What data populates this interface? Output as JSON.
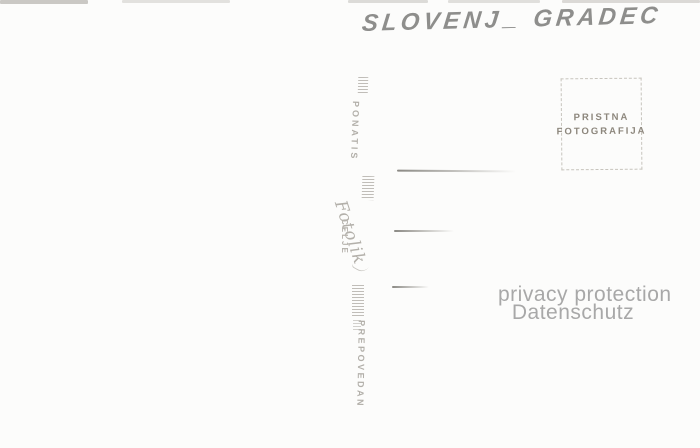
{
  "handwriting": {
    "part1": "SLOVENJ",
    "underscore": "_",
    "part2": "GRADEC",
    "color": "#8e8e8c"
  },
  "publisher_stamp": {
    "top_word": "PONATIS",
    "logo_script": "Fotolik",
    "logo_city": "CELJE",
    "bottom_word": "PREPOVEDAN",
    "ink_color": "#b2afa9"
  },
  "authenticity_stamp": {
    "line1": "PRISTNA",
    "line2": "FOTOGRAFIJA",
    "text_color": "#8d877d",
    "border_color": "#c7c4bd"
  },
  "address_lines": {
    "count": 3,
    "ink_color": "#6e6c66"
  },
  "watermark": {
    "line1": "privacy protection",
    "line2": "Datenschutz",
    "color": "#a8a8a8"
  },
  "background_color": "#fcfcfb"
}
